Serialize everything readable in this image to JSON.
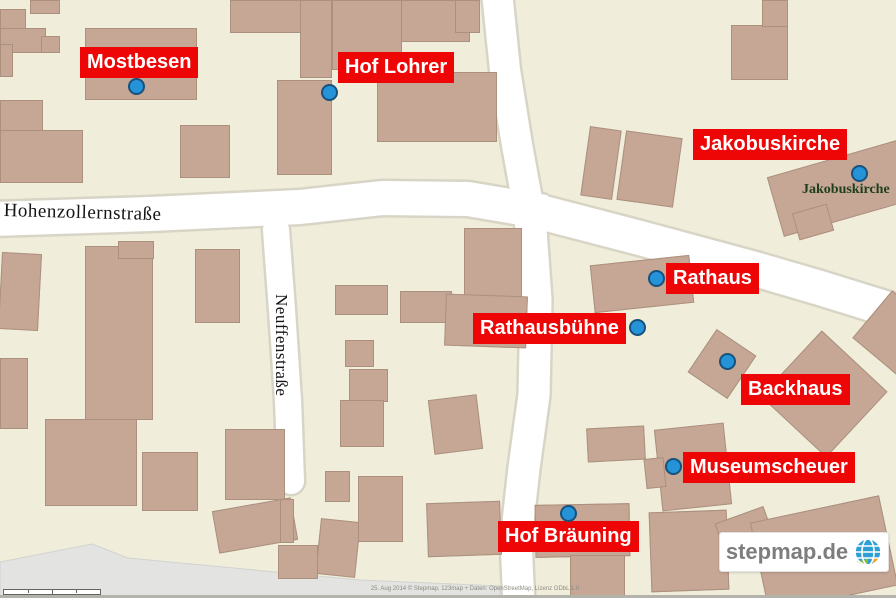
{
  "colors": {
    "background": "#f0eedb",
    "building_fill": "#c6a695",
    "building_border": "#ab907e",
    "street_fill": "#ffffff",
    "street_casing": "#d8d5c6",
    "marker_red": "#ee0606",
    "marker_text": "#ffffff",
    "dot_fill": "#2593d8",
    "dot_border": "#17527d",
    "poi_green": "#1e3e1e",
    "area_gray": "#e3e3e1"
  },
  "markers": [
    {
      "name": "mostbesen",
      "label": "Mostbesen",
      "label_x": 80,
      "label_y": 47,
      "dot_x": 136,
      "dot_y": 86
    },
    {
      "name": "hof-lohrer",
      "label": "Hof Lohrer",
      "label_x": 338,
      "label_y": 52,
      "dot_x": 329,
      "dot_y": 92
    },
    {
      "name": "jakobuskirche",
      "label": "Jakobuskirche",
      "label_x": 693,
      "label_y": 129,
      "dot_x": 859,
      "dot_y": 173
    },
    {
      "name": "rathaus",
      "label": "Rathaus",
      "label_x": 666,
      "label_y": 263,
      "dot_x": 656,
      "dot_y": 278
    },
    {
      "name": "rathausbuehne",
      "label": "Rathausbühne",
      "label_x": 473,
      "label_y": 313,
      "dot_x": 637,
      "dot_y": 327
    },
    {
      "name": "backhaus",
      "label": "Backhaus",
      "label_x": 741,
      "label_y": 374,
      "dot_x": 727,
      "dot_y": 361
    },
    {
      "name": "museumscheuer",
      "label": "Museumscheuer",
      "label_x": 683,
      "label_y": 452,
      "dot_x": 673,
      "dot_y": 466
    },
    {
      "name": "hof-braeuning",
      "label": "Hof Bräuning",
      "label_x": 498,
      "label_y": 521,
      "dot_x": 568,
      "dot_y": 513
    }
  ],
  "street_labels": [
    {
      "name": "hohenzollernstrasse",
      "text": "Hohenzollernstraße",
      "x": 4,
      "y": 200,
      "rotation": 1.5,
      "font_size": 19
    },
    {
      "name": "neuffenstrasse",
      "text": "Neuffenstraße",
      "x": 291,
      "y": 294,
      "rotation": 90,
      "font_size": 17
    }
  ],
  "poi_label": {
    "text": "Jakobuskirche",
    "x": 802,
    "y": 182,
    "font_size": 14
  },
  "streets": [
    {
      "name": "hohenzollernstrasse-west",
      "width": 34,
      "cap": "butt",
      "points": [
        [
          -8,
          219
        ],
        [
          150,
          214
        ],
        [
          300,
          207
        ],
        [
          382,
          198
        ],
        [
          468,
          199
        ],
        [
          545,
          212
        ]
      ]
    },
    {
      "name": "hohenzollernstrasse-east",
      "width": 34,
      "cap": "butt",
      "points": [
        [
          540,
          212
        ],
        [
          640,
          238
        ],
        [
          755,
          269
        ],
        [
          820,
          288
        ],
        [
          904,
          314
        ]
      ]
    },
    {
      "name": "north-street",
      "width": 30,
      "cap": "butt",
      "points": [
        [
          497,
          -8
        ],
        [
          505,
          70
        ],
        [
          517,
          145
        ],
        [
          530,
          216
        ]
      ]
    },
    {
      "name": "south-street",
      "width": 31,
      "cap": "butt",
      "points": [
        [
          530,
          216
        ],
        [
          536,
          300
        ],
        [
          534,
          395
        ],
        [
          524,
          468
        ],
        [
          516,
          540
        ],
        [
          519,
          606
        ]
      ]
    },
    {
      "name": "neuffenstrasse",
      "width": 26,
      "cap": "round",
      "points": [
        [
          276,
          230
        ],
        [
          282,
          310
        ],
        [
          288,
          400
        ],
        [
          291,
          481
        ]
      ]
    }
  ],
  "areas": [
    {
      "name": "parking-area",
      "fill": "#e3e3e1",
      "stroke": "#d2d2d0",
      "path": "M0,562 L92,544 L128,558 L360,580 L500,586 L500,598 L0,598 Z"
    }
  ],
  "buildings": [
    [
      30,
      0,
      30,
      14,
      0
    ],
    [
      0,
      9,
      26,
      23,
      0
    ],
    [
      0,
      28,
      46,
      25,
      0
    ],
    [
      41,
      36,
      19,
      17,
      0
    ],
    [
      0,
      44,
      13,
      33,
      0
    ],
    [
      0,
      100,
      43,
      32,
      0
    ],
    [
      0,
      130,
      83,
      53,
      0
    ],
    [
      85,
      28,
      112,
      72,
      0
    ],
    [
      180,
      125,
      50,
      53,
      0
    ],
    [
      230,
      0,
      72,
      33,
      0
    ],
    [
      300,
      0,
      32,
      78,
      0
    ],
    [
      332,
      0,
      138,
      42,
      0
    ],
    [
      332,
      0,
      70,
      70,
      0
    ],
    [
      455,
      0,
      25,
      33,
      0
    ],
    [
      277,
      80,
      55,
      95,
      0
    ],
    [
      377,
      72,
      120,
      70,
      0
    ],
    [
      731,
      25,
      57,
      55,
      0
    ],
    [
      762,
      0,
      26,
      27,
      0
    ],
    [
      585,
      128,
      32,
      70,
      8
    ],
    [
      621,
      134,
      57,
      70,
      8
    ],
    [
      772,
      152,
      175,
      62,
      -16
    ],
    [
      795,
      208,
      36,
      28,
      -16
    ],
    [
      0,
      253,
      40,
      77,
      3
    ],
    [
      85,
      246,
      68,
      174,
      0
    ],
    [
      118,
      241,
      36,
      18,
      0
    ],
    [
      195,
      249,
      45,
      74,
      0
    ],
    [
      0,
      358,
      28,
      71,
      0
    ],
    [
      45,
      419,
      92,
      87,
      0
    ],
    [
      142,
      452,
      56,
      59,
      0
    ],
    [
      225,
      429,
      60,
      71,
      0
    ],
    [
      335,
      285,
      53,
      30,
      0
    ],
    [
      400,
      291,
      52,
      32,
      0
    ],
    [
      345,
      340,
      29,
      27,
      0
    ],
    [
      349,
      369,
      39,
      33,
      0
    ],
    [
      340,
      400,
      44,
      47,
      0
    ],
    [
      431,
      397,
      49,
      55,
      -7
    ],
    [
      464,
      228,
      58,
      72,
      0
    ],
    [
      445,
      295,
      82,
      52,
      2
    ],
    [
      427,
      502,
      74,
      54,
      -2
    ],
    [
      215,
      504,
      80,
      43,
      -10
    ],
    [
      280,
      499,
      14,
      44,
      0
    ],
    [
      318,
      520,
      40,
      56,
      6
    ],
    [
      278,
      545,
      40,
      34,
      0
    ],
    [
      325,
      471,
      25,
      31,
      0
    ],
    [
      358,
      476,
      45,
      66,
      0
    ],
    [
      592,
      260,
      100,
      48,
      -6
    ],
    [
      698,
      338,
      48,
      52,
      34
    ],
    [
      779,
      349,
      90,
      90,
      43
    ],
    [
      865,
      303,
      62,
      62,
      40
    ],
    [
      658,
      426,
      70,
      82,
      -6
    ],
    [
      645,
      458,
      20,
      30,
      -6
    ],
    [
      587,
      427,
      58,
      34,
      -3
    ],
    [
      535,
      504,
      95,
      53,
      -1
    ],
    [
      570,
      555,
      55,
      43,
      0
    ],
    [
      650,
      511,
      78,
      80,
      -2
    ],
    [
      718,
      514,
      52,
      30,
      -20
    ],
    [
      758,
      508,
      132,
      92,
      -12
    ]
  ],
  "logo": {
    "text": "stepmap.de"
  },
  "attribution": {
    "text": "25. Aug 2014 © Stepmap, 123map + Daten: OpenStreetMap, Lizenz ODbL 1.0"
  }
}
